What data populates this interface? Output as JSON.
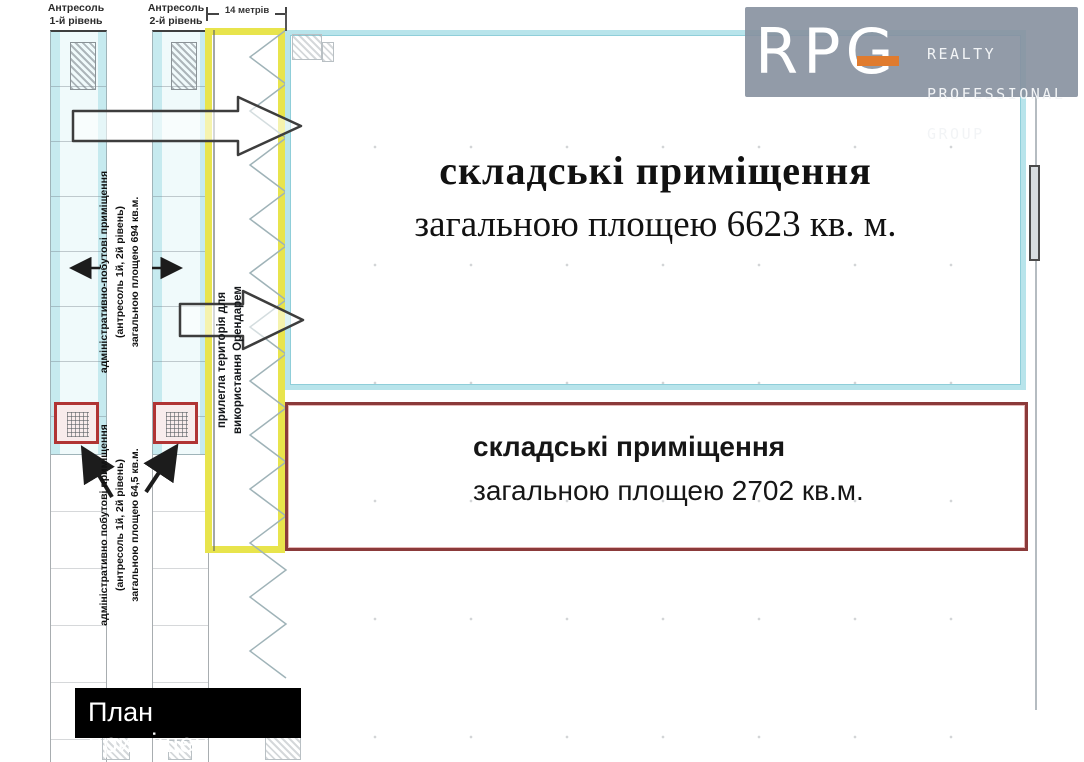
{
  "colors": {
    "cyan_border": "#b8e4eb",
    "yellow_border": "#e8e44c",
    "red_border": "#8b3a3a",
    "small_red_border": "#b03434",
    "logo_bg": "#8792a2",
    "logo_accent": "#e07b2e",
    "label_bg": "#000000"
  },
  "logo": {
    "brand": "RPG",
    "line1": "REALTY",
    "line2": "PROFESSIONAL",
    "line3": "GROUP"
  },
  "header": {
    "mezzanine_1": "Антресоль\n1-й рівень",
    "mezzanine_2": "Антресоль\n2-й рівень",
    "dimension": "14 метрів"
  },
  "zones": {
    "warehouse_main": {
      "title": "складські приміщення",
      "subtitle": "загальною площею 6623 кв. м."
    },
    "warehouse_secondary": {
      "title": "складські приміщення",
      "subtitle": "загальною площею 2702 кв.м."
    },
    "adjacent_territory": {
      "label": "прилегла територія для\nвикористання Орендарем"
    },
    "admin_upper": {
      "label": "адміністративно-побутові приміщення\n(антресоль 1й, 2й рівень)\nзагальною площею 694 кв.м."
    },
    "admin_lower": {
      "label": "адміністративно побутові приміщення\n(антресоль 1й, 2й рівень)\nзагальною площею 64,5 кв.м."
    }
  },
  "footer": {
    "plan_label": "План приміщення"
  }
}
